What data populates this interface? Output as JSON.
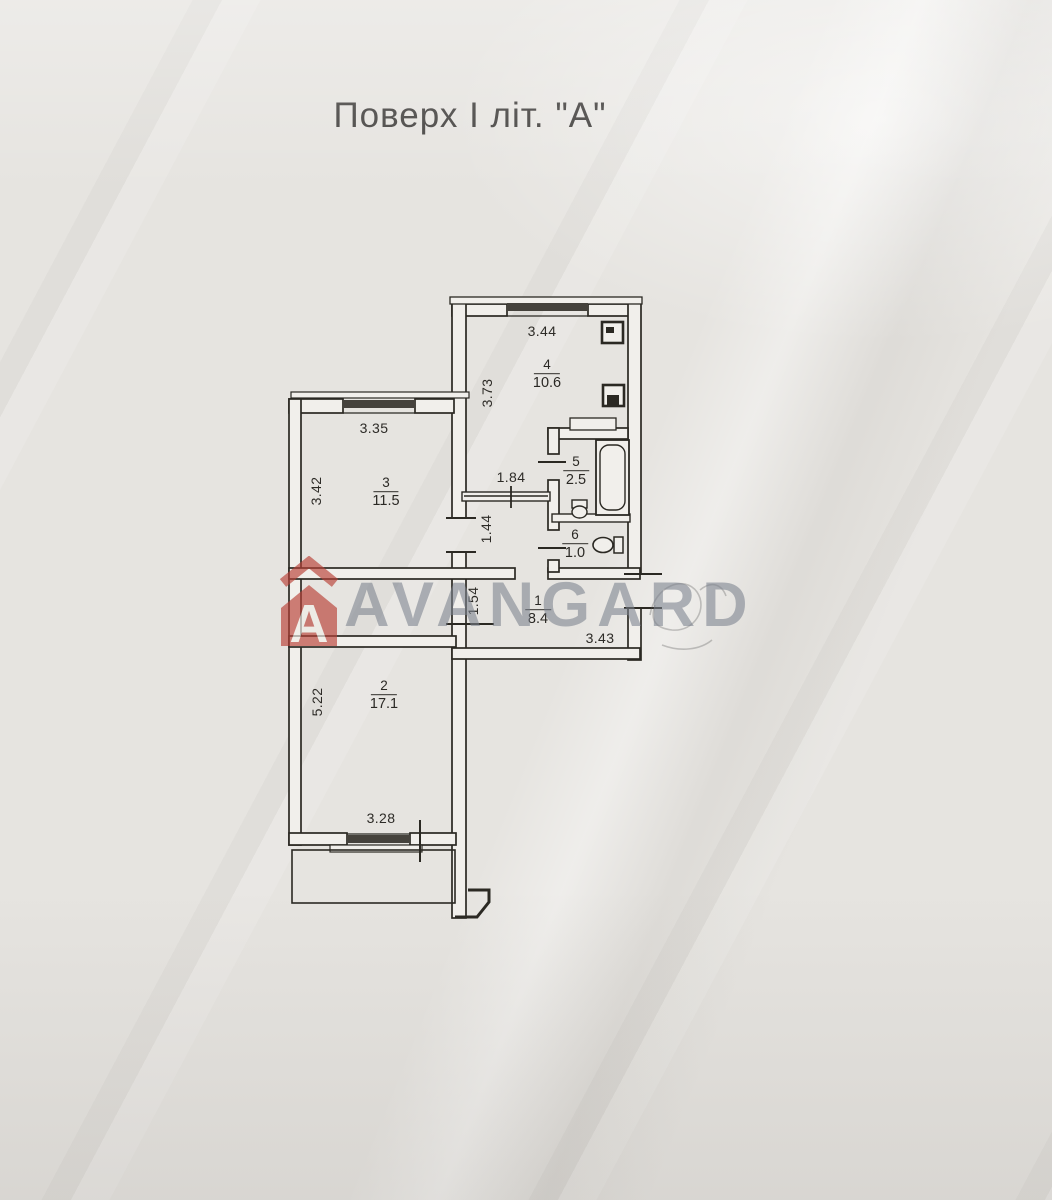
{
  "title": "Поверх І літ. \"А\"",
  "watermark": {
    "brand": "AVANGARD",
    "logo_letter": "A",
    "accent_color": "#b94137",
    "text_color": "#7a828d"
  },
  "plan": {
    "line_color": "#2b2923",
    "paper_color": "#e6e4e0",
    "rooms": [
      {
        "number": "1",
        "area": "8.4"
      },
      {
        "number": "2",
        "area": "17.1"
      },
      {
        "number": "3",
        "area": "11.5"
      },
      {
        "number": "4",
        "area": "10.6"
      },
      {
        "number": "5",
        "area": "2.5"
      },
      {
        "number": "6",
        "area": "1.0"
      }
    ],
    "dimensions": [
      {
        "value": "3.44"
      },
      {
        "value": "3.73"
      },
      {
        "value": "3.35"
      },
      {
        "value": "3.42"
      },
      {
        "value": "1.84"
      },
      {
        "value": "1.44"
      },
      {
        "value": "1.54"
      },
      {
        "value": "3.43"
      },
      {
        "value": "5.22"
      },
      {
        "value": "3.28"
      }
    ],
    "fixtures": [
      "bathtub",
      "toilet",
      "washbasin",
      "vent-shaft",
      "duct-box",
      "balcony"
    ]
  }
}
